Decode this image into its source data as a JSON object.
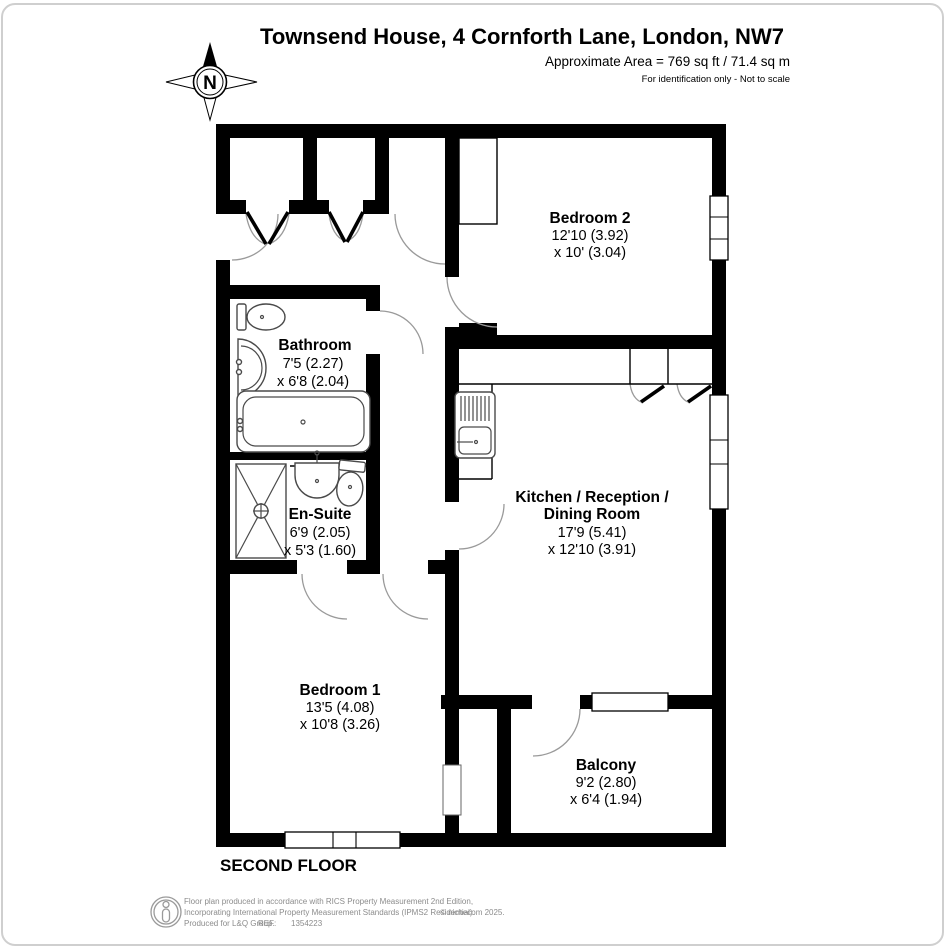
{
  "header": {
    "title": "Townsend House, 4 Cornforth Lane, London, NW7",
    "area": "Approximate Area = 769 sq ft / 71.4 sq m",
    "note": "For identification only - Not to scale",
    "compass": "N"
  },
  "floor_label": "SECOND FLOOR",
  "rooms": {
    "bedroom2": {
      "name": "Bedroom 2",
      "dim1": "12'10 (3.92)",
      "dim2": "x 10' (3.04)"
    },
    "bathroom": {
      "name": "Bathroom",
      "dim1": "7'5 (2.27)",
      "dim2": "x 6'8 (2.04)"
    },
    "kitchen": {
      "name1": "Kitchen / Reception /",
      "name2": "Dining Room",
      "dim1": "17'9 (5.41)",
      "dim2": "x 12'10 (3.91)"
    },
    "ensuite": {
      "name": "En-Suite",
      "dim1": "6'9 (2.05)",
      "dim2": "x 5'3 (1.60)"
    },
    "bedroom1": {
      "name": "Bedroom 1",
      "dim1": "13'5 (4.08)",
      "dim2": "x 10'8 (3.26)"
    },
    "balcony": {
      "name": "Balcony",
      "dim1": "9'2 (2.80)",
      "dim2": "x 6'4 (1.94)"
    }
  },
  "fixtures": [
    "toilet",
    "basin",
    "bathtub",
    "shower",
    "vanity-sink",
    "kitchen-sink-drainer"
  ],
  "footer": {
    "line1": "Floor plan produced in accordance with RICS Property Measurement 2nd Edition,",
    "line2": "Incorporating International Property Measurement Standards (IPMS2 Residential).",
    "copyright": "© nichecom 2025.",
    "produced": "Produced for L&Q Group.",
    "ref_label": "REF:",
    "ref_value": "1354223"
  },
  "colors": {
    "wall": "#000000",
    "fixture_outline": "#4a4a4a",
    "door_arc": "#9a9a9a",
    "footer_text": "#8c8c8c",
    "page_border": "#cfcfcf"
  }
}
